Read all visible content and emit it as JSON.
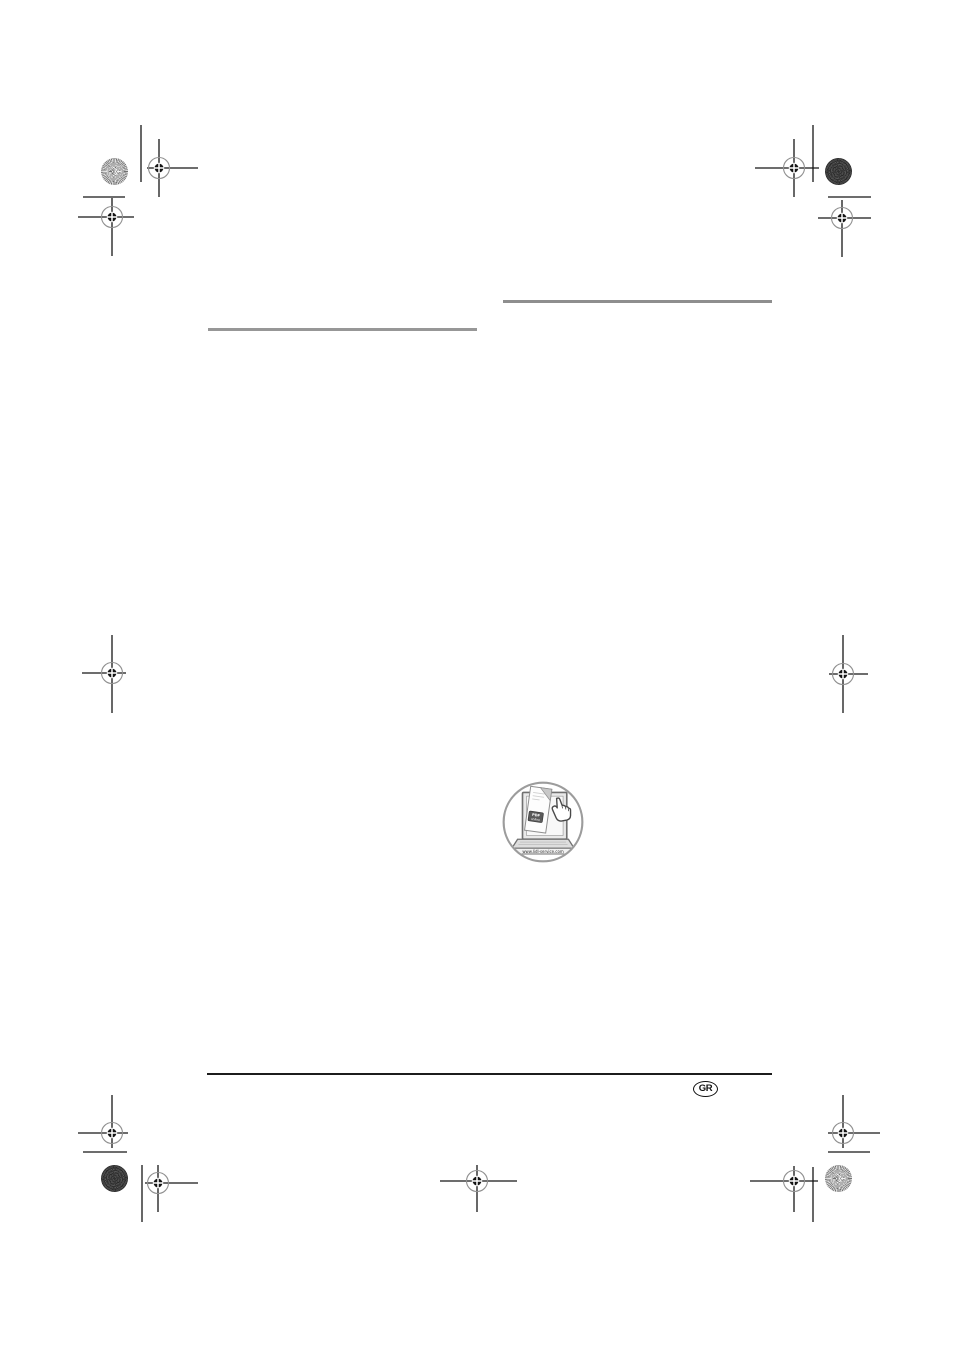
{
  "page": {
    "language_badge": "GR",
    "background_color": "#ffffff"
  },
  "rules": {
    "left_heading_rule_color": "#979797",
    "right_heading_rule_color": "#8e8e8e",
    "footer_rule_color": "#1c1c1c"
  },
  "service_icon": {
    "url_label": "www.lidl-service.com",
    "badge_line1": "PDF",
    "badge_line2": "online",
    "ring_color": "#9c9c9c"
  },
  "print_marks": {
    "crosshair_color": "#161616",
    "ring_color": "#8f8f8f"
  }
}
